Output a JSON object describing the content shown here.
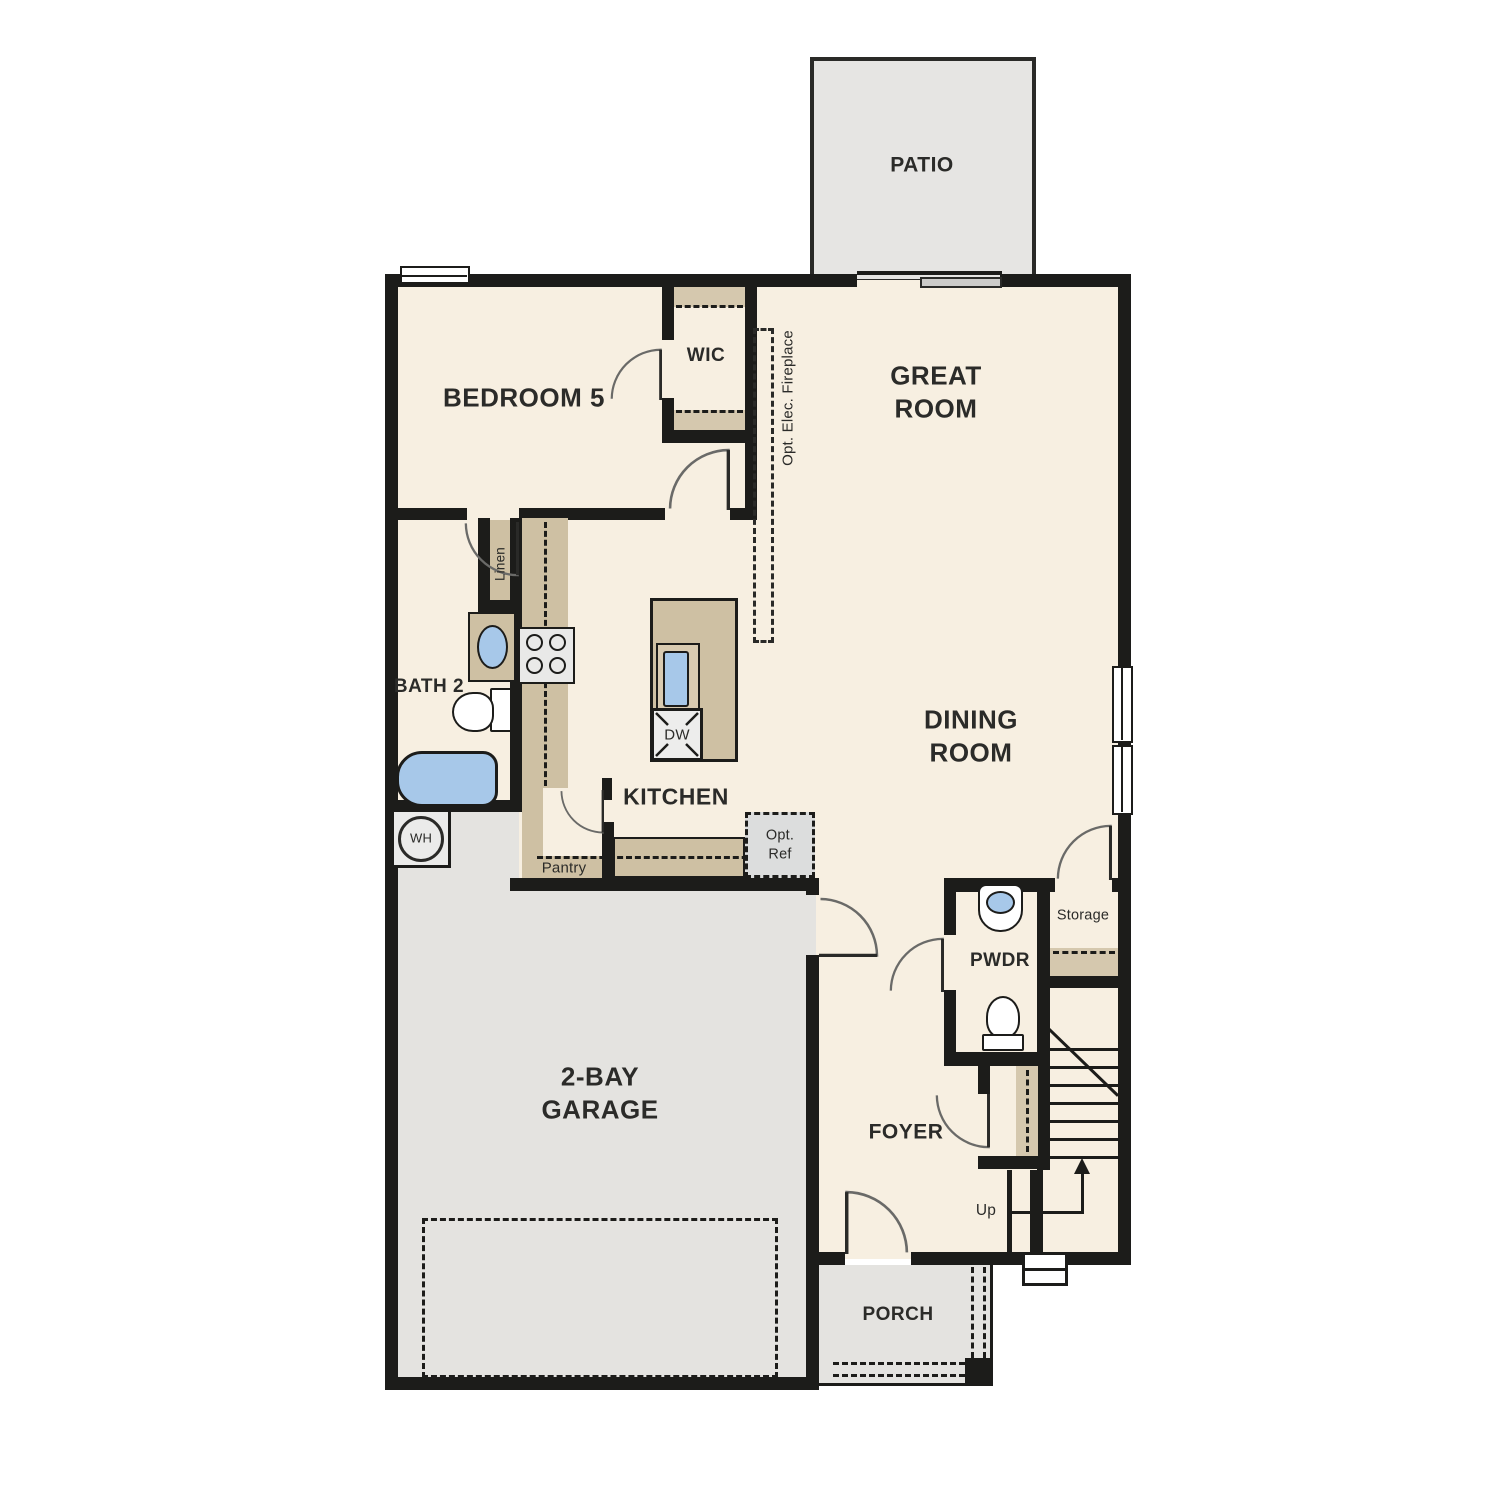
{
  "plan_title": "First Floor Plan",
  "colors": {
    "wall": "#1c1c1a",
    "floor": "#f7efe1",
    "concrete": "#e4e3e0",
    "cabinet_tan": "#cec0a3",
    "shelf_tan": "#d5c8ae",
    "fixture_blue": "#a7c8e9"
  },
  "rooms": {
    "patio": "PATIO",
    "bedroom5": "BEDROOM 5",
    "wic": "WIC",
    "great_room": "GREAT\nROOM",
    "bath2": "BATH 2",
    "kitchen": "KITCHEN",
    "dining_room": "DINING\nROOM",
    "powder": "PWDR",
    "storage": "Storage",
    "foyer": "FOYER",
    "garage": "2-BAY\nGARAGE",
    "porch": "PORCH"
  },
  "features": {
    "fireplace": "Opt. Elec. Fireplace",
    "linen": "Linen",
    "pantry": "Pantry",
    "opt_ref": "Opt.\nRef",
    "dishwasher": "DW",
    "water_heater": "WH",
    "stairs_up": "Up"
  }
}
